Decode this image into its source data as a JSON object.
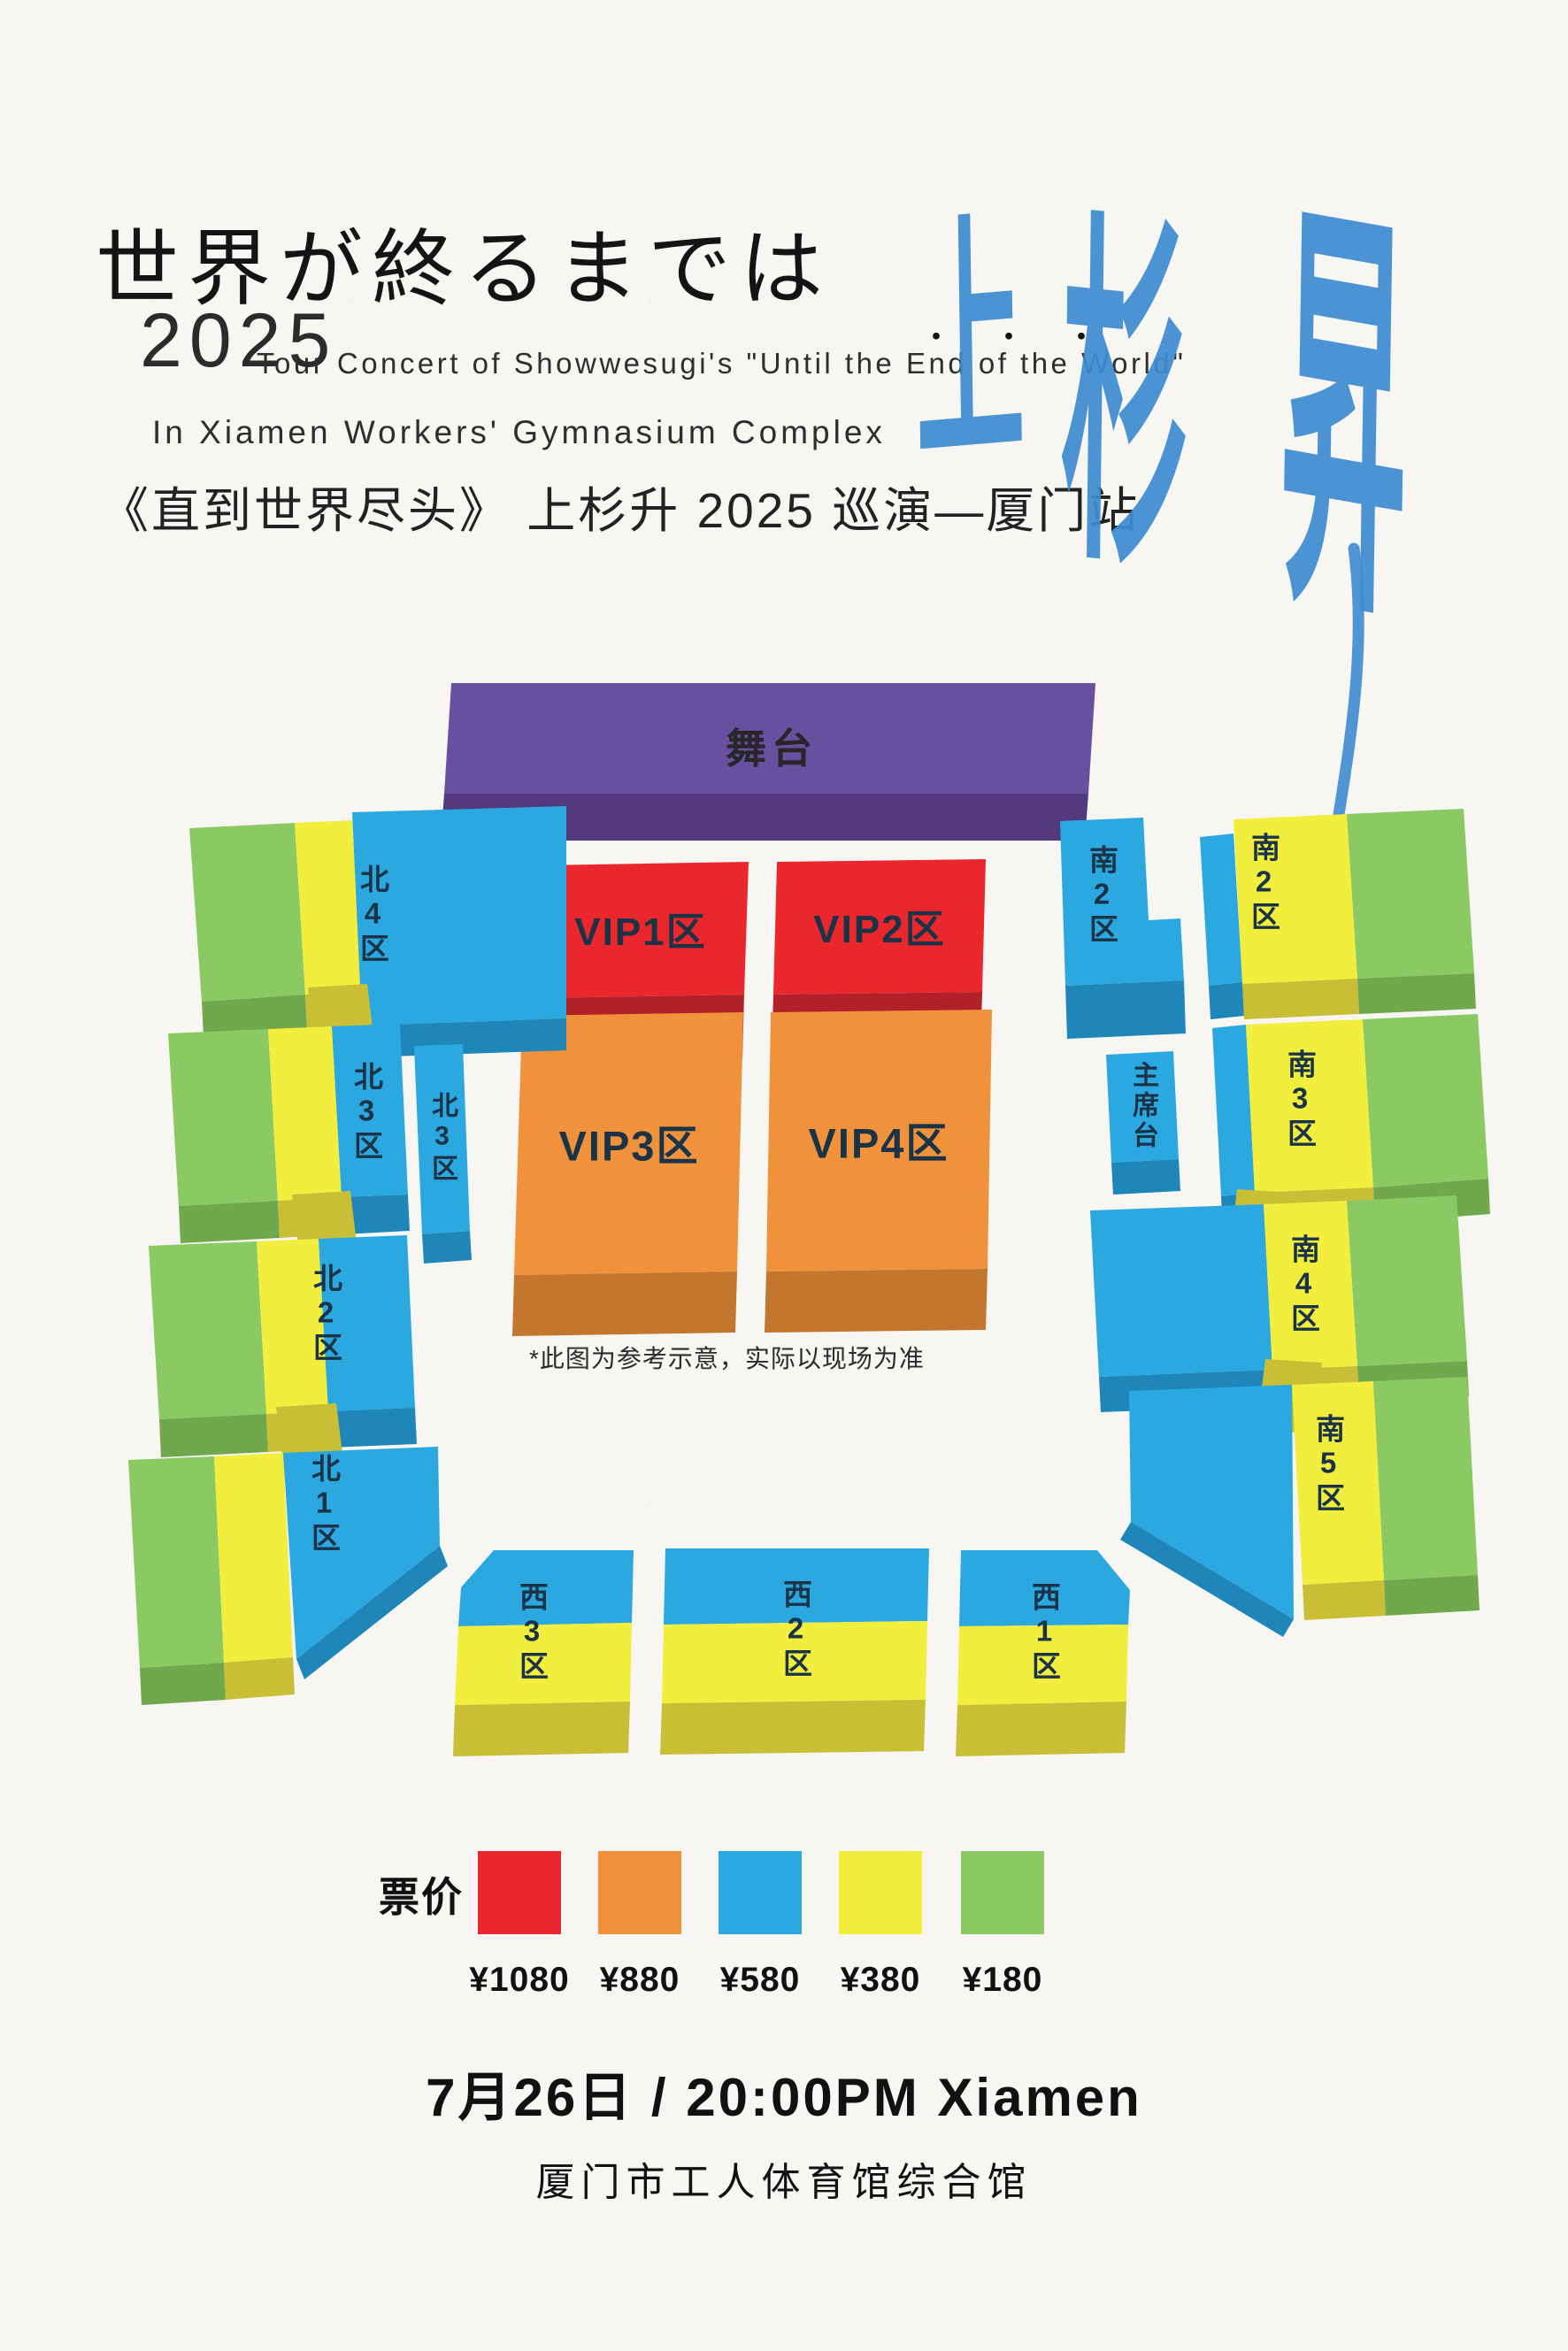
{
  "header": {
    "jp_title": "世界が終るまでは",
    "jp_title_dots": "・・・",
    "year": "2025",
    "en_line1": "Tour Concert of Showwesugi's \"Until the End of the World\"",
    "en_line2": "In Xiamen Workers' Gymnasium Complex",
    "cn_subtitle": "《直到世界尽头》 上杉升 2025 巡演—厦门站",
    "calligraphy": {
      "char1": "上",
      "char2": "杉",
      "char3": "昇",
      "color": "#3e8cd0"
    }
  },
  "map": {
    "stage_label": "舞台",
    "note": "*此图为参考示意，实际以现场为准",
    "sections": {
      "vip1": "VIP1区",
      "vip2": "VIP2区",
      "vip3": "VIP3区",
      "vip4": "VIP4区",
      "north4": "北4区",
      "north3_a": "北3区",
      "north3_b": "北3区",
      "north2": "北2区",
      "north1": "北1区",
      "south2_inner": "南2区",
      "podium": "主席台",
      "south2": "南2区",
      "south3": "南3区",
      "south4": "南4区",
      "south5": "南5区",
      "west3": "西3区",
      "west2": "西2区",
      "west1": "西1区"
    }
  },
  "legend": {
    "label": "票价",
    "items": [
      {
        "color": "#e9272c",
        "price": "¥1080"
      },
      {
        "color": "#f0913c",
        "price": "¥880"
      },
      {
        "color": "#2ca8e0",
        "price": "¥580"
      },
      {
        "color": "#f2ee3e",
        "price": "¥380"
      },
      {
        "color": "#8bc963",
        "price": "¥180"
      }
    ]
  },
  "footer": {
    "datetime": "7月26日 / 20:00PM  Xiamen",
    "venue": "厦门市工人体育馆综合馆"
  },
  "palette": {
    "background": "#f7f6f2",
    "stage_top": "#6850a0",
    "stage_front": "#533a7e",
    "red_top": "#e9272c",
    "red_front": "#b2202a",
    "orange_top": "#f0913c",
    "orange_front": "#c3762d",
    "blue_top": "#2ca8e0",
    "blue_front": "#1f86ba",
    "yellow_top": "#f2ee3e",
    "yellow_front": "#c9bf37",
    "green_top": "#8bc963",
    "green_front": "#71a84e",
    "label_text": "#1b3347",
    "title_text": "#141414"
  }
}
